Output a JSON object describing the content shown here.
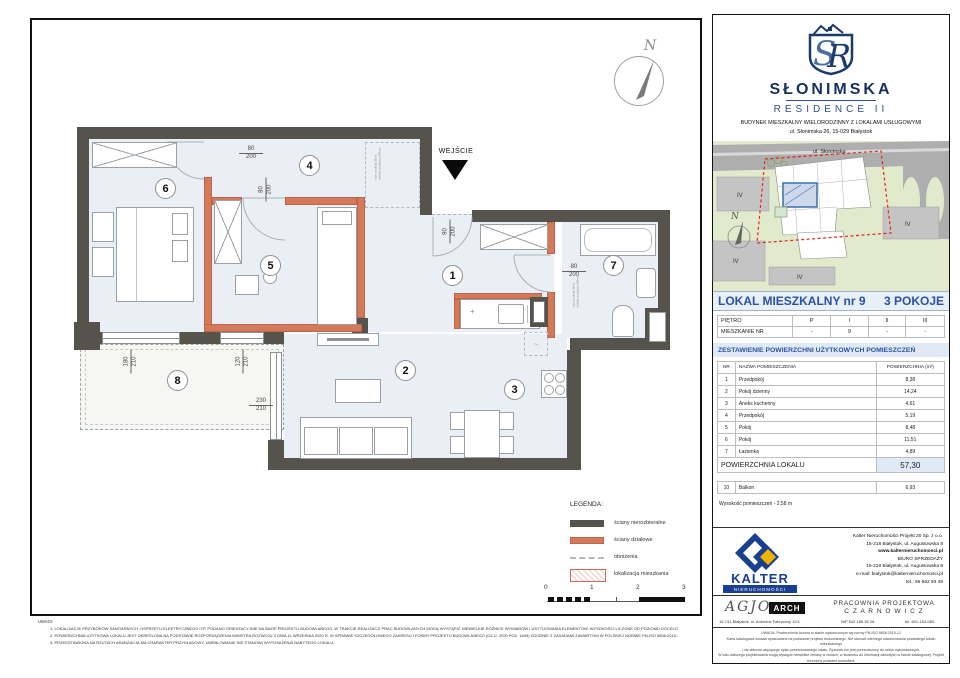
{
  "plan": {
    "entrance_label": "WEJŚCIE",
    "north_label": "N",
    "rooms": [
      "1",
      "2",
      "3",
      "4",
      "5",
      "6",
      "7",
      "8"
    ],
    "dims": {
      "door_room6": {
        "w": "80",
        "h": "200"
      },
      "door_room5": {
        "w": "80",
        "h": "200"
      },
      "door_entry": {
        "w": "90",
        "h": "200"
      },
      "door_bath": {
        "w": "80",
        "h": "200"
      },
      "window_left": {
        "w": "180",
        "h": "210"
      },
      "window_mid": {
        "w": "120",
        "h": "210"
      },
      "balcony_door": {
        "w": "230",
        "h": "210"
      }
    },
    "annotations": {
      "a1": "wys. podłogi 28cm",
      "a2": "światło przejścia 200cm"
    },
    "legend": {
      "title": "LEGENDA:",
      "items": [
        {
          "label": "ściany nierozbieralne"
        },
        {
          "label": "ściany działowe"
        },
        {
          "label": "obniżenia"
        },
        {
          "label": "lokalizacja mieszkania"
        }
      ],
      "scale_ticks": [
        "0",
        "1",
        "2",
        "3"
      ]
    },
    "notes": {
      "title": "UWAGI:",
      "items": [
        "1.    LOKALIZACJE PRZYBORÓW SANITARNYCH, OSPRZĘTU ELEKTRYCZNEGO ITP. PODANO ORIENTACYJNIE NA BAZIE PROJEKTU BUDOWLANEGO. W TRAKCIE REALIZACJI PRAC BUDOWLANYCH MOGĄ WYSTĄPIĆ NIEWIELKIE RÓŻNICE WYMIARÓW I USYTUOWANIA ELEMENTÓW. WYSOKOŚCI LICZONE OD POZIOMU DOCELOWEGO WYKOŃCZENIA PODŁÓG.",
        "2.    POWIERZCHNIA UŻYTKOWA LOKALU JEST OKREŚLONA NA PODSTAWIE ROZPORZĄDZENIA MINISTRA ROZWOJU Z DNIA 11 WRZEŚNIA 2020 R. W SPRAWIE SZCZEGÓŁOWEGO ZAKRESU I FORMY PROJEKTU BUDOWLANEGO (DZ.U. 2020 POZ. 1609) ZGODNIE Z ZASADAMI ZAWARTYMI W POLSKIEJ NORMIE PN-ISO 9836:2015-12.",
        "3.    PRZEDSTAWIONA NA RZUTACH ARANŻACJA MA CHARAKTER PRZYKŁADOWY. UMEBLOWANIE NIE STANOWI WYPOSAŻENIA NABYTEGO LOKALU."
      ]
    }
  },
  "panel": {
    "brand": {
      "monogram": "SR",
      "name": "SŁONIMSKA",
      "line2": "RESIDENCE II",
      "subtitle": "BUDYNEK MIESZKALNY WIELORODZINNY Z LOKALAMI USŁUGOWYMI",
      "address": "ul. Słonimska 26, 15-029 Białystok"
    },
    "site": {
      "street": "ul. Słonimska",
      "block_label": "IV",
      "north": "N"
    },
    "unit": {
      "title": "LOKAL MIESZKALNY  nr 9",
      "type": "3 POKOJE"
    },
    "floor_table": {
      "row1_label": "PIĘTRO",
      "row1": [
        "P",
        "I",
        "II",
        "III"
      ],
      "row2_label": "MIESZKANIE NR",
      "row2": [
        "-",
        "9",
        "-",
        "-"
      ]
    },
    "area_table": {
      "section_title": "ZESTAWIENIE POWIERZCHNI UŻYTKOWYCH POMIESZCZEŃ",
      "headers": {
        "nr": "NR",
        "name": "NAZWA POMIESZCZENIA",
        "area": "POWIERZCHNIA (m²)"
      },
      "rows": [
        {
          "nr": "1",
          "name": "Przedpokój",
          "area": "8,38"
        },
        {
          "nr": "2",
          "name": "Pokój dzienny",
          "area": "14,24"
        },
        {
          "nr": "3",
          "name": "Aneks kuchenny",
          "area": "4,61"
        },
        {
          "nr": "4",
          "name": "Przedpokój",
          "area": "5,19"
        },
        {
          "nr": "5",
          "name": "Pokój",
          "area": "8,48"
        },
        {
          "nr": "6",
          "name": "Pokój",
          "area": "11,51"
        },
        {
          "nr": "7",
          "name": "Łazienka",
          "area": "4,89"
        }
      ],
      "total_label": "POWIERZCHNIA LOKALU",
      "total_value": "57,30",
      "balcony": {
        "nr": "10",
        "name": "Balkon",
        "area": "6,93"
      },
      "height_note": "Wysokość pomieszczeń - 2,58 m"
    },
    "kalter": {
      "name": "KALTER",
      "sub": "NIERUCHOMOŚCI",
      "lines": [
        "Kalter Nieruchomości Projekt 20  Sp. z o.o.",
        "15-218 Białystok, ul. Augustowska 8",
        "www.kalternieruchomosci.pl",
        "BIURO SPRZEDAŻY",
        "15-218 Białystok, ul. Augustowska 8",
        "e-mail: bialystok@kalternieruchomosci.pl",
        "tel.: 85 662 93 48"
      ]
    },
    "agjo": {
      "name": "AGJO",
      "arch": "ARCH",
      "address": "15-741 Białystok,  ul. Antoniuk Fabryczny  12/1"
    },
    "pracownia": {
      "line1": "PRACOWNIA PROJEKTOWA",
      "line2": "C Z A R N O W I C Z",
      "nip": "NIP  542 186 35 28",
      "tel": "tel. 601-154-080"
    },
    "fine_print": [
      "UWAGA:   Powierzchnia liczona w stanie wykończonym wg normy PN-ISO 9836:2015-12",
      "Karta katalogowa została opracowana na podstawie projektu budowlanego. Nie stanowi wiernego odwzorowania powstałego lokalu mieszkalnego",
      "i nie stanowi wiążącego opisu prezentowanego lokalu. Rysunek nie jest przeznaczony do celów wykonawczych.",
      "W toku dalszego projektowania mogą wystąpić niewielkie zmiany w rzutach, w stosunku do informacji zawartych w karcie katalogowej. Projekt chroniony prawami autorskimi."
    ]
  },
  "colors": {
    "accent_blue": "#2b52a8",
    "navy": "#16305e",
    "wall_dark": "#55534c",
    "wall_partition": "#d5795b",
    "room_fill": "#e9eff5",
    "kalter_blue": "#1b3f8f",
    "kalter_yellow": "#f0b400",
    "red_dashed": "#e22818"
  }
}
